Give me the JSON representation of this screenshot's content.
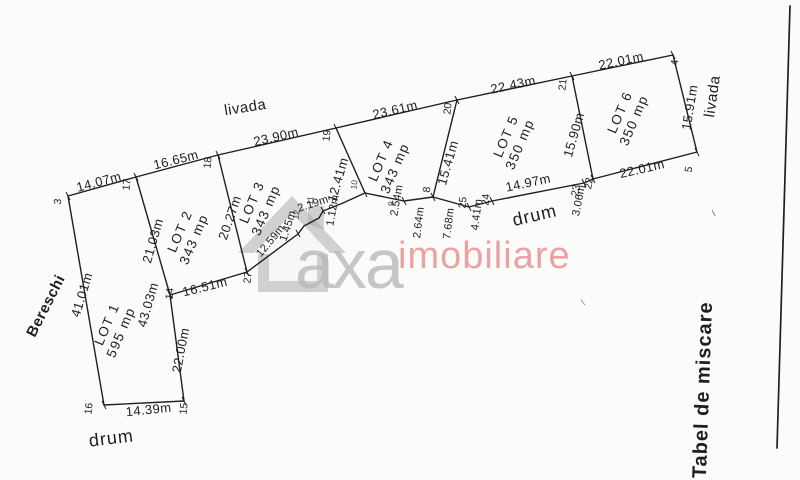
{
  "labels": {
    "livada_top": "livada",
    "livada_right": "livada",
    "bereschi": "Bereschi",
    "drum_left": "drum",
    "drum_right": "drum",
    "side_table_title": "Tabel de miscare"
  },
  "watermark": {
    "brand_gray": "axa",
    "brand_pink": "imobiliare"
  },
  "lots": [
    {
      "name": "LOT 1",
      "area": "595 mp"
    },
    {
      "name": "LOT 2",
      "area": "343 mp"
    },
    {
      "name": "LOT 3",
      "area": "343 mp"
    },
    {
      "name": "LOT 4",
      "area": "343 mp"
    },
    {
      "name": "LOT 5",
      "area": "350 mp"
    },
    {
      "name": "LOT 6",
      "area": "350 mp"
    }
  ],
  "measurements": {
    "lot1_top": "14.07m",
    "lot1_left": "41.01m",
    "lot1_right_upper": "21.03m",
    "lot1_right_total": "43.03m",
    "lot1_right_lower": "22.00m",
    "lot1_bottom": "14.39m",
    "lot2_top": "16.65m",
    "lot2_right": "20.27m",
    "lot2_bottom": "16.51m",
    "lot3_top": "23.90m",
    "lot3_right": "12.41m",
    "lot4_top": "23.61m",
    "lot4_right": "15.41m",
    "lot5_top": "22.43m",
    "lot5_right": "15.90m",
    "lot6_top": "22.01m",
    "lot6_right": "15.91m",
    "lot6_bottom": "22.01m",
    "step_12_59": "12.59m",
    "step_1_45": "1.45m",
    "step_2_19": "2.19m",
    "step_1_12": "1.12m",
    "step_2_54": "2.54m",
    "step_2_64": "2.64m",
    "step_7_68": "7.68m",
    "step_4_41": "4.41m",
    "drum_14_97": "14.97m",
    "drum_3_06": "3.06m"
  },
  "points": {
    "p3": "3",
    "p4": "4",
    "p5": "5",
    "p8": "8",
    "p9": "9",
    "p10": "10",
    "p11": "11",
    "p12": "12",
    "p14": "14",
    "p15": "15",
    "p16": "16",
    "p17": "17",
    "p18": "18",
    "p19": "19",
    "p20": "20",
    "p21": "21",
    "p22": "22",
    "p23": "23",
    "p24": "24",
    "p25": "25",
    "p27": "27"
  },
  "colors": {
    "ink": "#1f1f1f",
    "paper": "#fbfbfa",
    "wm_gray": "#b9b9b9",
    "wm_pink": "#ea9f9f",
    "wm_house": "#a6a6a6"
  }
}
